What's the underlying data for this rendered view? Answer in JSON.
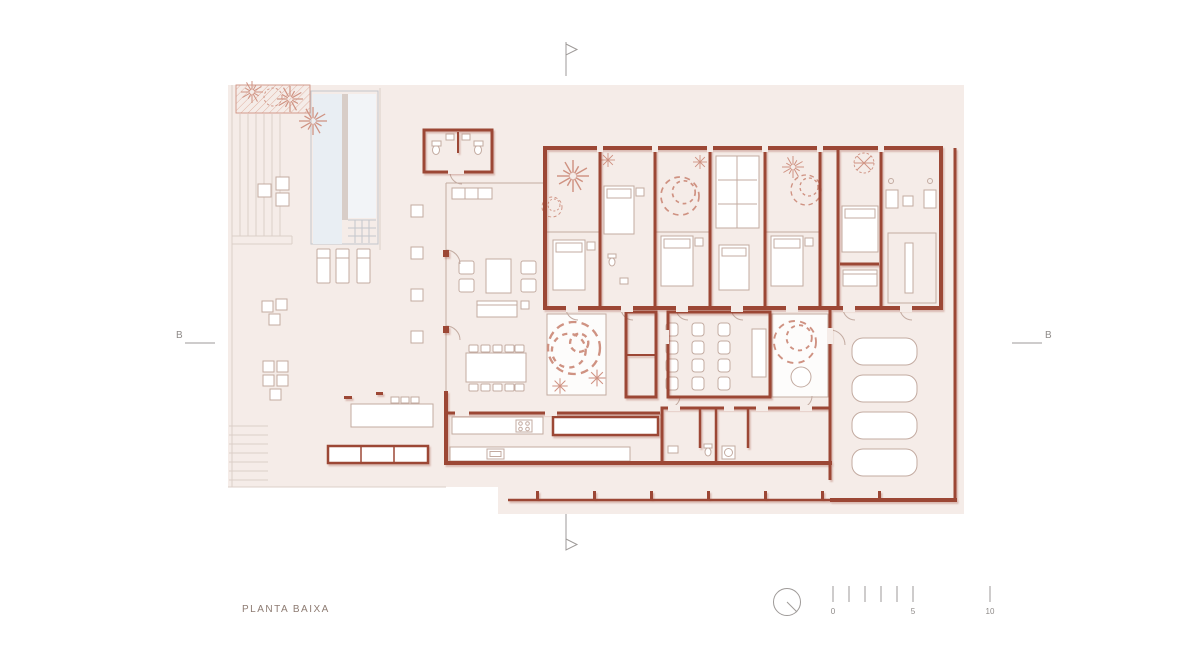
{
  "drawing": {
    "title": "PLANTA BAIXA",
    "section_marker_left": "B",
    "section_marker_right": "B",
    "scale_bar": {
      "label_start": "0",
      "label_mid": "5",
      "label_end": "10",
      "minor_ticks": 6
    },
    "symbols": {
      "north_indicator": "compass-circle",
      "section_cut_vertical": "pennant-flag",
      "section_cut_horizontal": "letter-with-line"
    }
  },
  "colors": {
    "paper": "#ffffff",
    "site_fill": "#f5ece8",
    "wall": "#9c4734",
    "pool_water": "#e9eef3",
    "furniture_line": "#c3aba1",
    "vegetation_line": "#cf9282",
    "annotation_line": "#9e9a98",
    "label_text": "#8d7b72"
  }
}
